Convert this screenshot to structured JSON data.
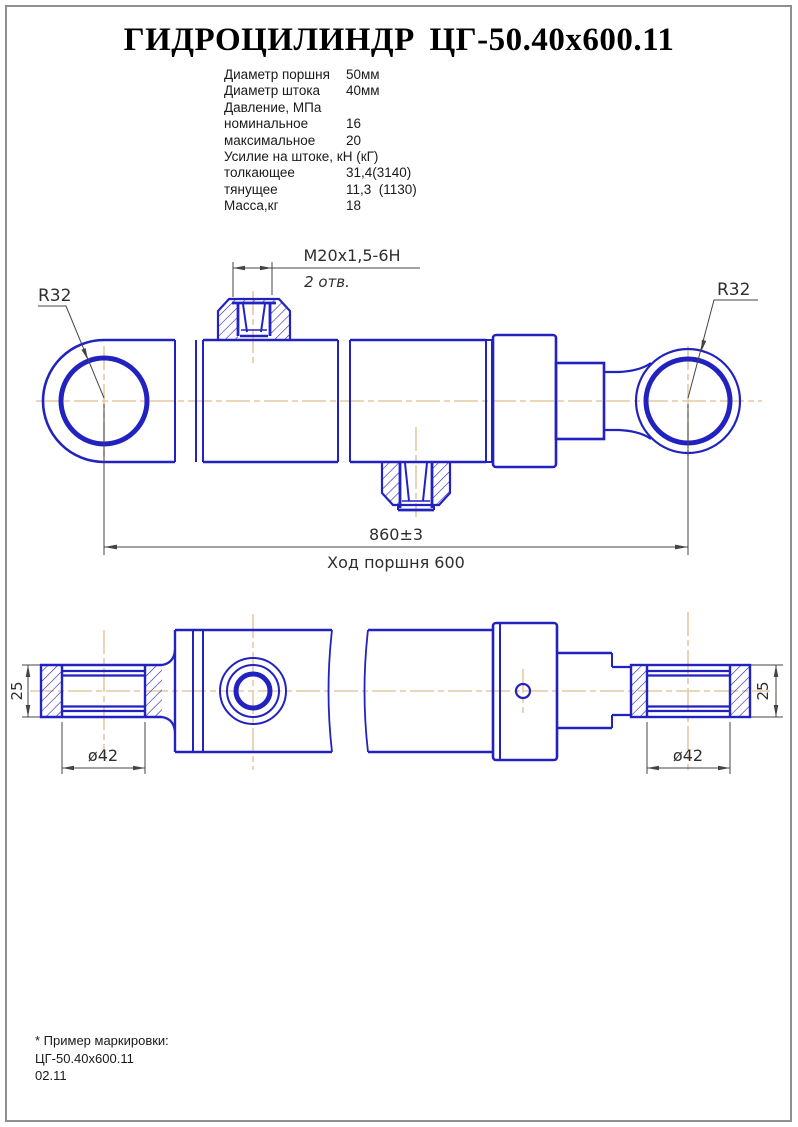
{
  "page": {
    "title": "ГИДРОЦИЛИНДР ЦГ-50.40х600.11"
  },
  "specs": {
    "rows": [
      {
        "label": "Диаметр поршня",
        "value": "50мм"
      },
      {
        "label": "Диаметр штока",
        "value": "40мм"
      },
      {
        "label": "Давление, МПа",
        "value": ""
      },
      {
        "label": "номинальное",
        "value": "16"
      },
      {
        "label": "максимальное",
        "value": "20"
      },
      {
        "label": "Усилие на штоке, кН (кГ)",
        "value": ""
      },
      {
        "label": "толкающее",
        "value": "31,4(3140)"
      },
      {
        "label": "тянущее",
        "value": "11,3  (1130)"
      },
      {
        "label": "Масса,кг",
        "value": "18"
      }
    ]
  },
  "drawing": {
    "thread_callout": "M20x1,5-6H",
    "thread_holes": "2 отв.",
    "radius_left": "R32",
    "radius_right": "R32",
    "length_dim": "860±3",
    "stroke_dim": "Ход поршня 600",
    "eye_width_left": "25",
    "eye_width_right": "25",
    "eye_dia_left": "ø42",
    "eye_dia_right": "ø42",
    "colors": {
      "line": "#2222c0",
      "centerline": "#e6c9a3",
      "dim": "#444444"
    }
  },
  "footer": {
    "line1": "* Пример маркировки:",
    "line2": "ЦГ-50.40х600.11",
    "line3": "02.11"
  }
}
